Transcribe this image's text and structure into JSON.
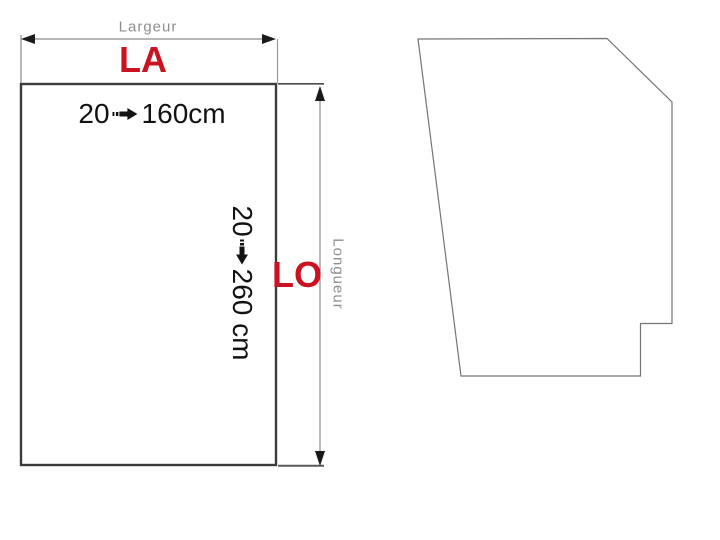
{
  "diagram": {
    "width_dimension": {
      "name": "Largeur",
      "code": "LA",
      "min": "20",
      "max": "160cm"
    },
    "length_dimension": {
      "name": "Longueur",
      "code": "LO",
      "min": "20",
      "max": "260 cm"
    }
  },
  "icons": {
    "range_arrow": "right-arrow-with-dashed-tail",
    "dimension_arrows": "double-headed"
  },
  "colors": {
    "accent_red": "#cb1220",
    "dim_label_gray": "#8e8e8e",
    "text_black": "#121212",
    "rectangle_border": "#3b3b3b",
    "thin_line_gray": "#7d7d7d",
    "arrowhead_black": "#1a1a1a",
    "background": "#ffffff"
  }
}
